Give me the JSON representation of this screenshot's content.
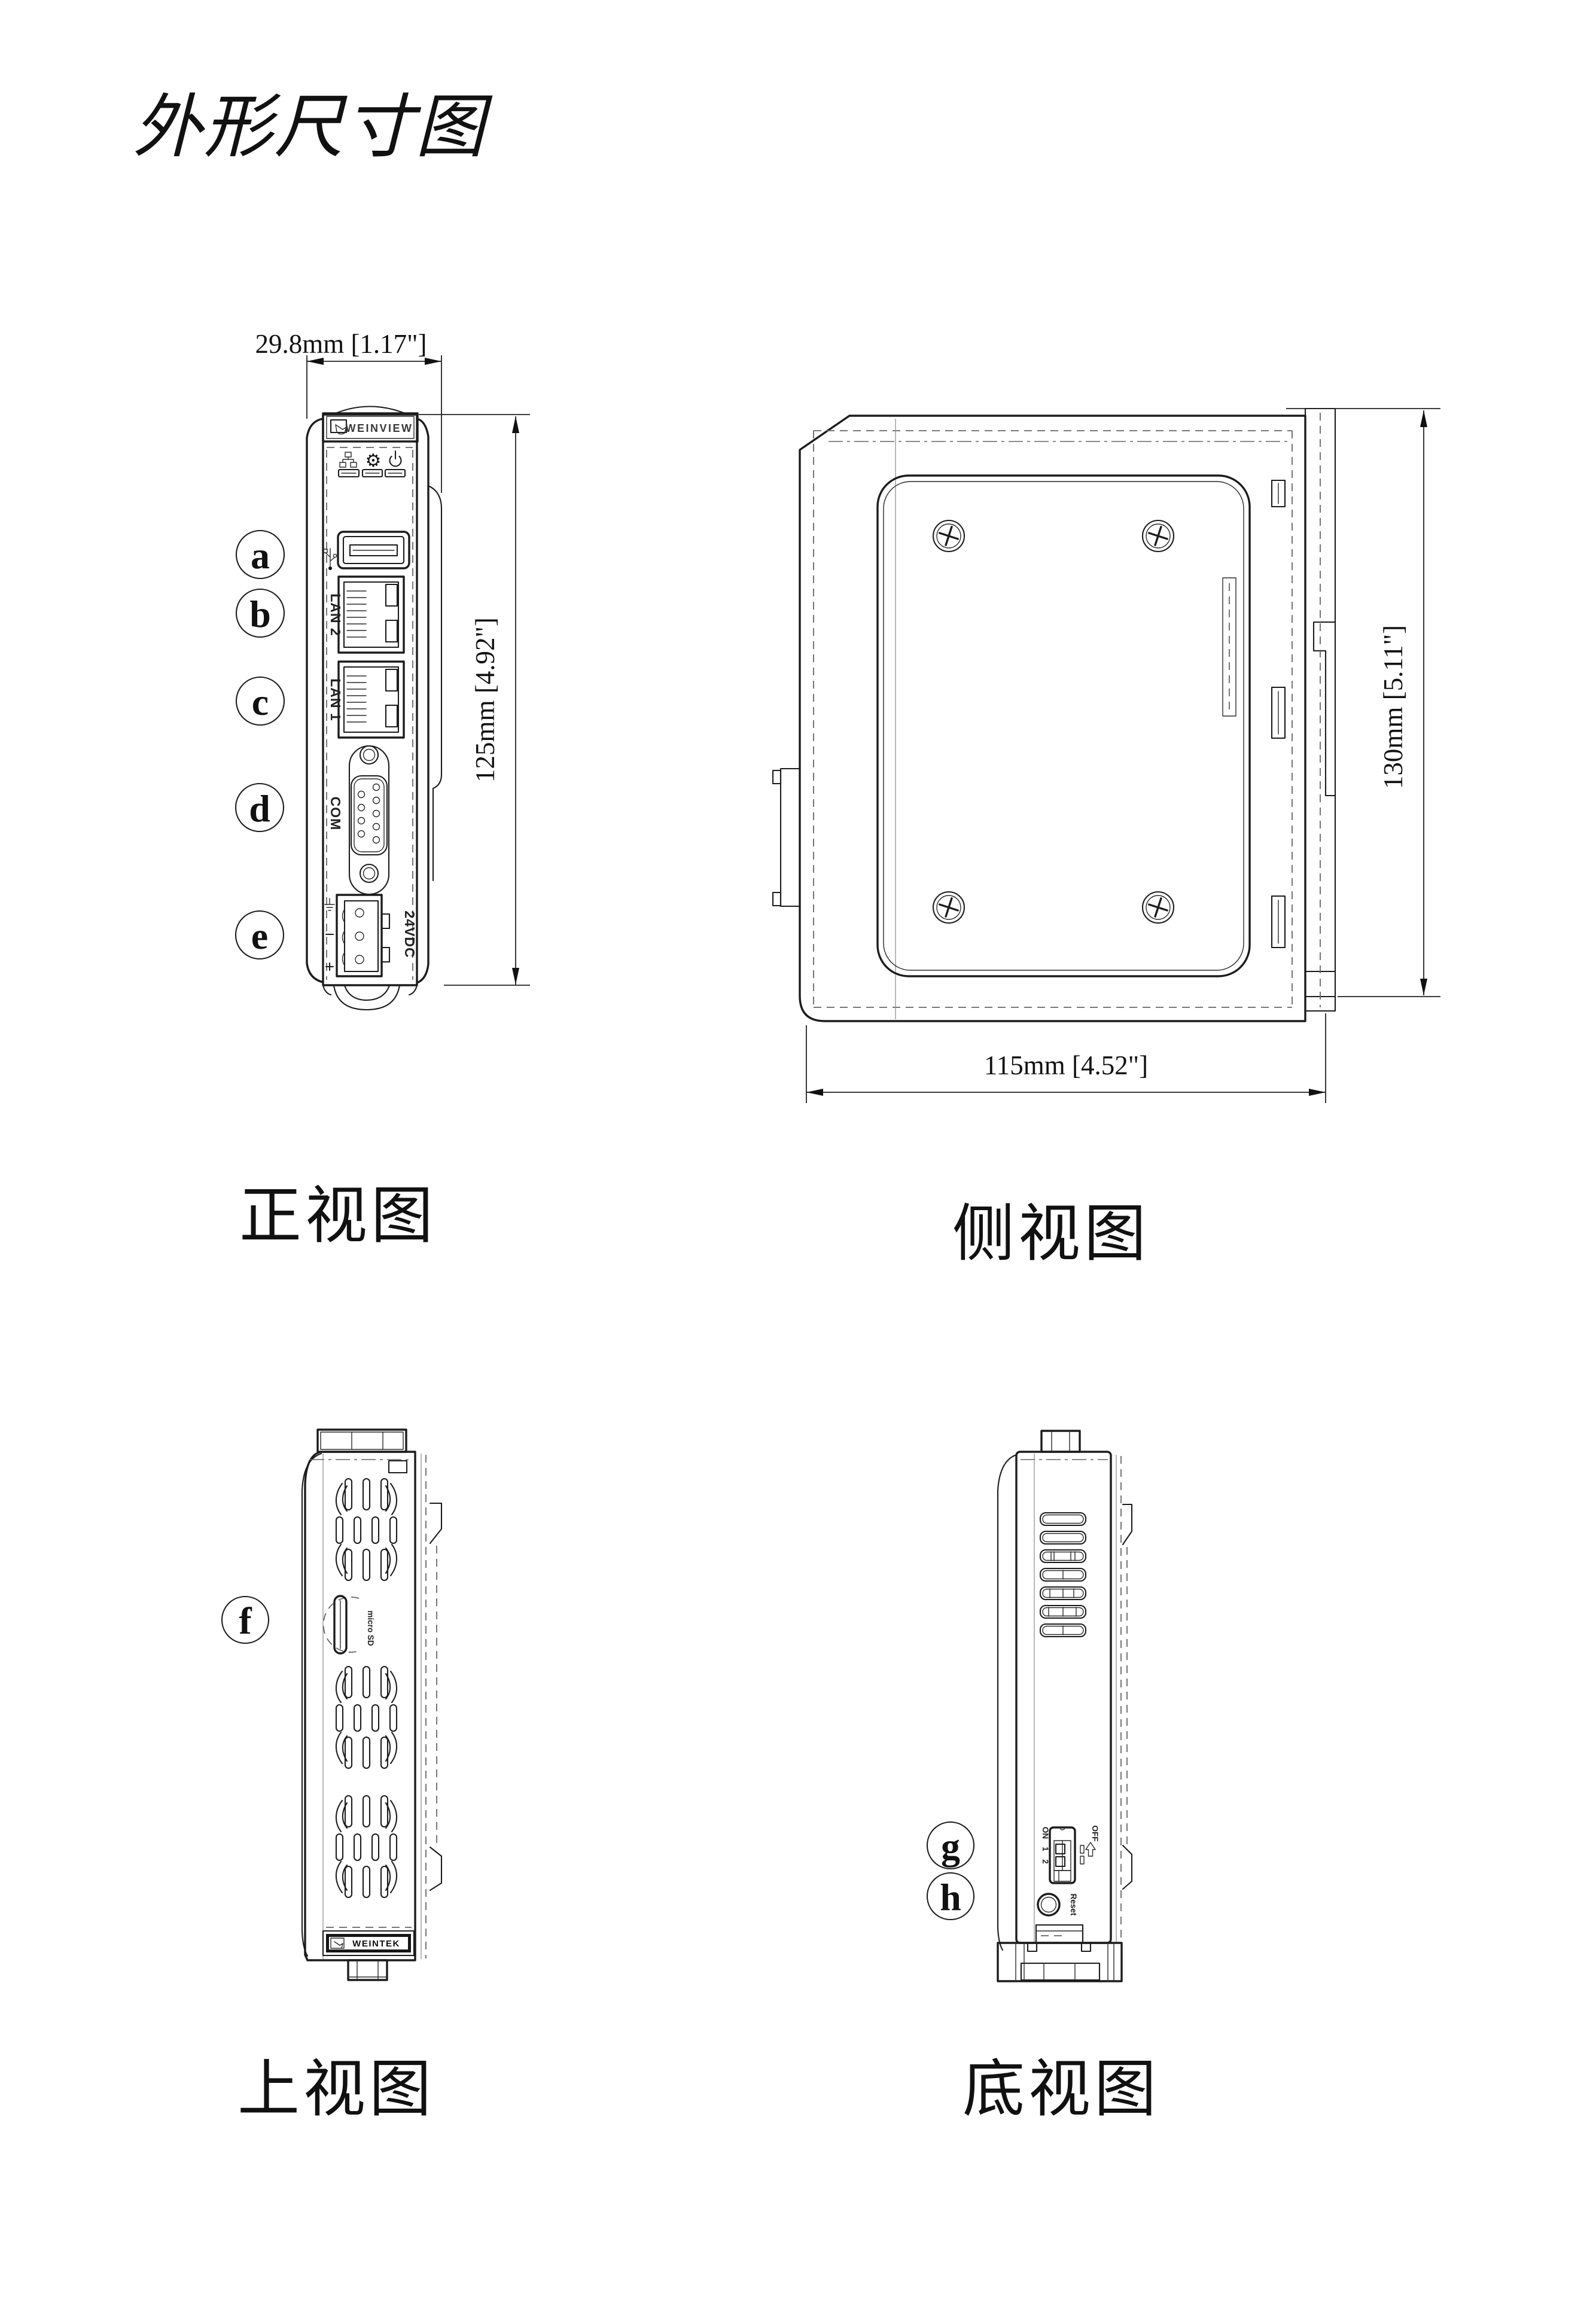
{
  "title": "外形尺寸图",
  "views": {
    "front": {
      "caption": "正视图"
    },
    "side": {
      "caption": "侧视图"
    },
    "top": {
      "caption": "上视图"
    },
    "bottom": {
      "caption": "底视图"
    }
  },
  "dimensions": {
    "front_width": "29.8mm [1.17\"]",
    "front_height": "125mm [4.92\"]",
    "side_height": "130mm [5.11\"]",
    "side_depth": "115mm [4.52\"]"
  },
  "callouts": {
    "a": "a",
    "b": "b",
    "c": "c",
    "d": "d",
    "e": "e",
    "f": "f",
    "g": "g",
    "h": "h"
  },
  "port_labels": {
    "lan2": "LAN 2",
    "lan1": "LAN 1",
    "com": "COM",
    "power": "24VDC"
  },
  "brand": {
    "front_view_logo": "WEINVIEW",
    "top_view_logo": "WEINTEK",
    "sd_logo": "micro SD"
  },
  "controls": {
    "dip_on": "ON",
    "dip_off": "OFF",
    "dip_1": "1",
    "dip_2": "2",
    "reset": "Reset"
  },
  "icons": {
    "gear_glyph": "⚙"
  }
}
